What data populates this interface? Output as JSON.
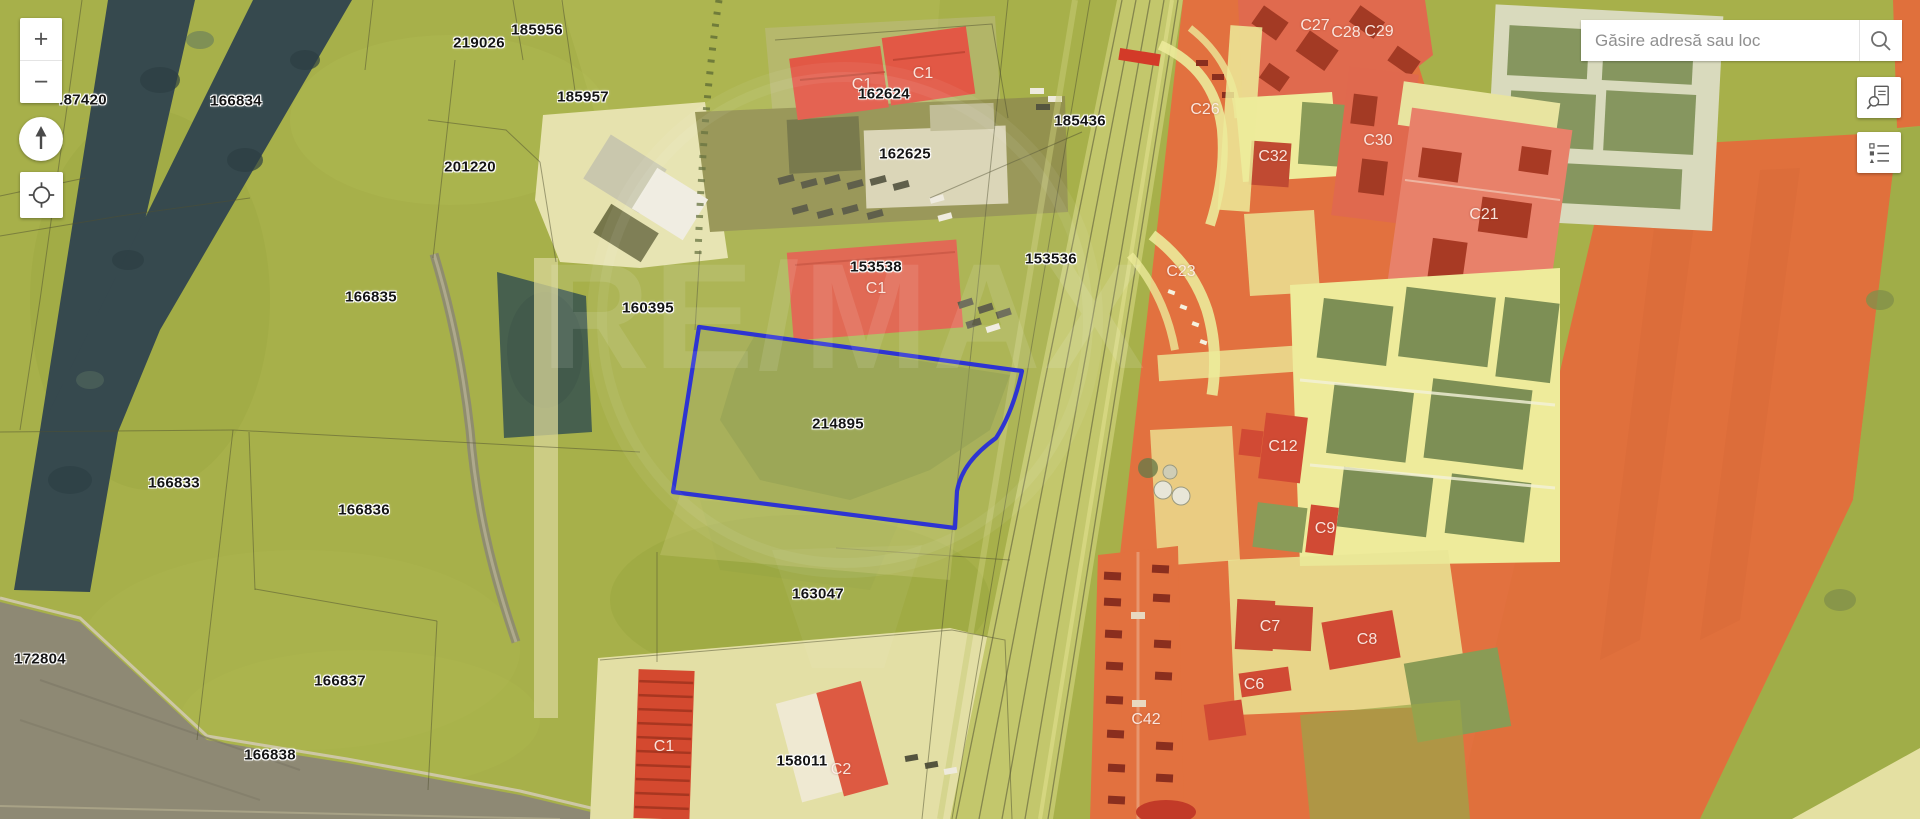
{
  "search": {
    "placeholder": "Găsire adresă sau loc"
  },
  "controls": {
    "zoom_in": "+",
    "zoom_out": "−",
    "compass_icon": "north-arrow",
    "locate_icon": "crosshair",
    "search_icon": "magnifier",
    "parcel_search_icon": "document-magnifier",
    "legend_icon": "layer-list"
  },
  "map": {
    "watermark": "RE/MAX",
    "selected_parcel": {
      "id": "214895",
      "outline_color": "#1F25CF"
    },
    "parcel_labels": [
      {
        "text": ".87420",
        "x": 83,
        "y": 100
      },
      {
        "text": "219026",
        "x": 479,
        "y": 43
      },
      {
        "text": "185956",
        "x": 537,
        "y": 30
      },
      {
        "text": "166834",
        "x": 236,
        "y": 101
      },
      {
        "text": "185957",
        "x": 583,
        "y": 97
      },
      {
        "text": "201220",
        "x": 470,
        "y": 167
      },
      {
        "text": "162624",
        "x": 884,
        "y": 94
      },
      {
        "text": "185436",
        "x": 1080,
        "y": 121
      },
      {
        "text": "162625",
        "x": 905,
        "y": 154
      },
      {
        "text": "166835",
        "x": 371,
        "y": 297
      },
      {
        "text": "160395",
        "x": 648,
        "y": 308
      },
      {
        "text": "153538",
        "x": 876,
        "y": 267
      },
      {
        "text": "153536",
        "x": 1051,
        "y": 259
      },
      {
        "text": "214895",
        "x": 838,
        "y": 424
      },
      {
        "text": "166833",
        "x": 174,
        "y": 483
      },
      {
        "text": "166836",
        "x": 364,
        "y": 510
      },
      {
        "text": "163047",
        "x": 818,
        "y": 594
      },
      {
        "text": "172804",
        "x": 40,
        "y": 659
      },
      {
        "text": "166837",
        "x": 340,
        "y": 681
      },
      {
        "text": "166838",
        "x": 270,
        "y": 755
      },
      {
        "text": "158011",
        "x": 802,
        "y": 761
      }
    ],
    "building_labels": [
      {
        "text": "C1",
        "x": 862,
        "y": 85
      },
      {
        "text": "C1",
        "x": 923,
        "y": 74
      },
      {
        "text": "C26",
        "x": 1205,
        "y": 110
      },
      {
        "text": "C27",
        "x": 1315,
        "y": 26
      },
      {
        "text": "C28",
        "x": 1346,
        "y": 33
      },
      {
        "text": "C29",
        "x": 1379,
        "y": 32
      },
      {
        "text": "C32",
        "x": 1273,
        "y": 157
      },
      {
        "text": "C30",
        "x": 1378,
        "y": 141
      },
      {
        "text": "C21",
        "x": 1484,
        "y": 215
      },
      {
        "text": "C23",
        "x": 1181,
        "y": 272
      },
      {
        "text": "C1",
        "x": 876,
        "y": 289
      },
      {
        "text": "C12",
        "x": 1283,
        "y": 447
      },
      {
        "text": "C9",
        "x": 1325,
        "y": 529
      },
      {
        "text": "C7",
        "x": 1270,
        "y": 627
      },
      {
        "text": "C8",
        "x": 1367,
        "y": 640
      },
      {
        "text": "C6",
        "x": 1254,
        "y": 685
      },
      {
        "text": "C42",
        "x": 1146,
        "y": 720
      },
      {
        "text": "C1",
        "x": 664,
        "y": 747
      },
      {
        "text": "C2",
        "x": 841,
        "y": 770
      }
    ]
  },
  "colors": {
    "field_green": "#A7B04A",
    "forest_navy": "#36494E",
    "industrial_orange": "#E2713F",
    "building_red": "#D8503A",
    "selection_blue": "#1F25CF",
    "plowed_grey": "#8E8974",
    "parcel_yellow": "#EEEB9B"
  }
}
